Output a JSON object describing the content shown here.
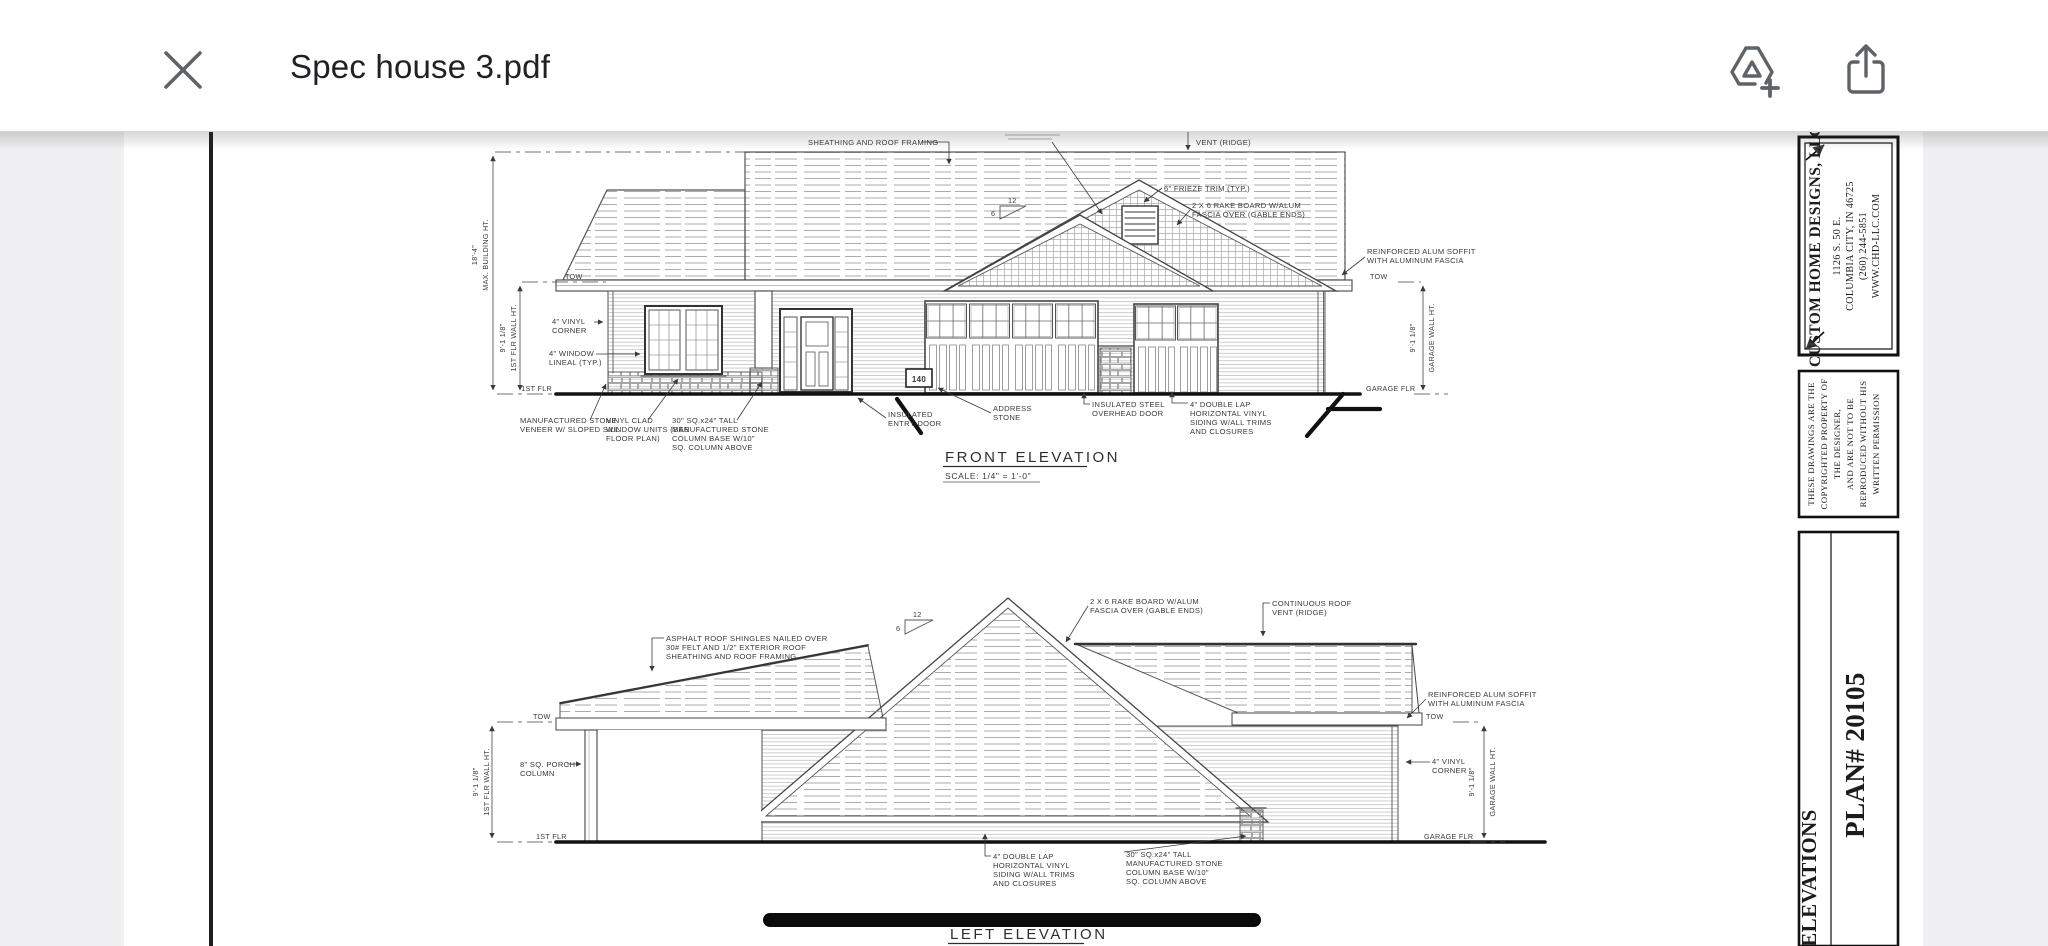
{
  "toolbar": {
    "title": "Spec house 3.pdf"
  },
  "sheet": {
    "front": {
      "title": "FRONT ELEVATION",
      "scale": "SCALE: 1/4\" = 1'-0\"",
      "address_number": "140",
      "slope": {
        "run": "12",
        "rise": "6"
      },
      "dims": {
        "tow": "TOW",
        "first_floor": "1ST FLR",
        "garage_floor": "GARAGE FLR",
        "building_height": "18'-4\"",
        "building_height_label": "MAX. BUILDING HT.",
        "wall_height": "9'-1 1/8\"",
        "wall_height_label": "1ST FLR WALL HT.",
        "garage_wall_height": "9'-1 1/8\"",
        "garage_wall_height_label": "GARAGE WALL HT."
      },
      "labels": {
        "sheathing": [
          "SHEATHING AND ROOF FRAMING"
        ],
        "vent": [
          "VENT (RIDGE)"
        ],
        "frieze": [
          "6\" FRIEZE TRIM (TYP.)"
        ],
        "rake": [
          "2 X 6 RAKE BOARD W/ALUM",
          "FASCIA OVER (GABLE ENDS)"
        ],
        "soffit": [
          "REINFORCED ALUM SOFFIT",
          "WITH ALUMINUM FASCIA"
        ],
        "vinyl_corner": [
          "4\" VINYL",
          "CORNER"
        ],
        "window_lineal": [
          "4\" WINDOW",
          "LINEAL (TYP.)"
        ],
        "stone_veneer": [
          "MANUFACTURED STONE",
          "VENEER W/ SLOPED SILL"
        ],
        "windows": [
          "VINYL CLAD",
          "WINDOW UNITS (SEE",
          "FLOOR PLAN)"
        ],
        "column": [
          "30\" SQ.x24\" TALL",
          "MANUFACTURED STONE",
          "COLUMN BASE W/10\"",
          "SQ. COLUMN ABOVE"
        ],
        "entry": [
          "INSULATED",
          "ENTRY DOOR"
        ],
        "address": [
          "ADDRESS",
          "STONE"
        ],
        "overhead": [
          "INSULATED STEEL",
          "OVERHEAD DOOR"
        ],
        "siding": [
          "4\" DOUBLE LAP",
          "HORIZONTAL VINYL",
          "SIDING W/ALL TRIMS",
          "AND CLOSURES"
        ]
      }
    },
    "left": {
      "title": "LEFT ELEVATION",
      "scale": "SCALE: 1/4\" = 1'-0\"",
      "slope": {
        "run": "12",
        "rise": "6"
      },
      "dims": {
        "tow": "TOW",
        "first_floor": "1ST FLR",
        "garage_floor": "GARAGE FLR",
        "wall_height": "9'-1 1/8\"",
        "wall_height_label": "1ST FLR WALL HT.",
        "garage_wall_height": "9'-1 1/8\"",
        "garage_wall_height_label": "GARAGE WALL HT."
      },
      "labels": {
        "roofing": [
          "ASPHALT ROOF SHINGLES NAILED OVER",
          "30# FELT AND 1/2\" EXTERIOR ROOF",
          "SHEATHING AND ROOF FRAMING"
        ],
        "rake": [
          "2 X 6 RAKE BOARD W/ALUM",
          "FASCIA OVER (GABLE ENDS)"
        ],
        "ridge_vent": [
          "CONTINUOUS ROOF",
          "VENT (RIDGE)"
        ],
        "soffit": [
          "REINFORCED ALUM SOFFIT",
          "WITH ALUMINUM FASCIA"
        ],
        "porch_column": [
          "8\" SQ. PORCH",
          "COLUMN"
        ],
        "vinyl_corner": [
          "4\" VINYL",
          "CORNER"
        ],
        "siding": [
          "4\" DOUBLE LAP",
          "HORIZONTAL VINYL",
          "SIDING W/ALL TRIMS",
          "AND CLOSURES"
        ],
        "column": [
          "30\" SQ.x24\" TALL",
          "MANUFACTURED STONE",
          "COLUMN BASE W/10\"",
          "SQ. COLUMN ABOVE"
        ]
      }
    },
    "titleblock": {
      "company": "CUSTOM HOME DESIGNS, LLC",
      "address": [
        "1126 S. 50 E.",
        "COLUMBIA CITY, IN  46725",
        "(260) 244-5851",
        "WWW.CHD-LLC.COM"
      ],
      "copyright": [
        "THESE DRAWINGS ARE THE",
        "COPYRIGHTED PROPERTY OF",
        "THE DESIGNER,",
        "AND ARE NOT TO BE",
        "REPRODUCED WITHOUT HIS",
        "WRITTEN PERMISSION"
      ],
      "sheet_name": "ELEVATIONS",
      "plan_number": "PLAN# 20105"
    }
  },
  "colors": {
    "icon": "#5f6368",
    "line": "#3a3a3a",
    "background_gray": "#f0f0f2"
  }
}
